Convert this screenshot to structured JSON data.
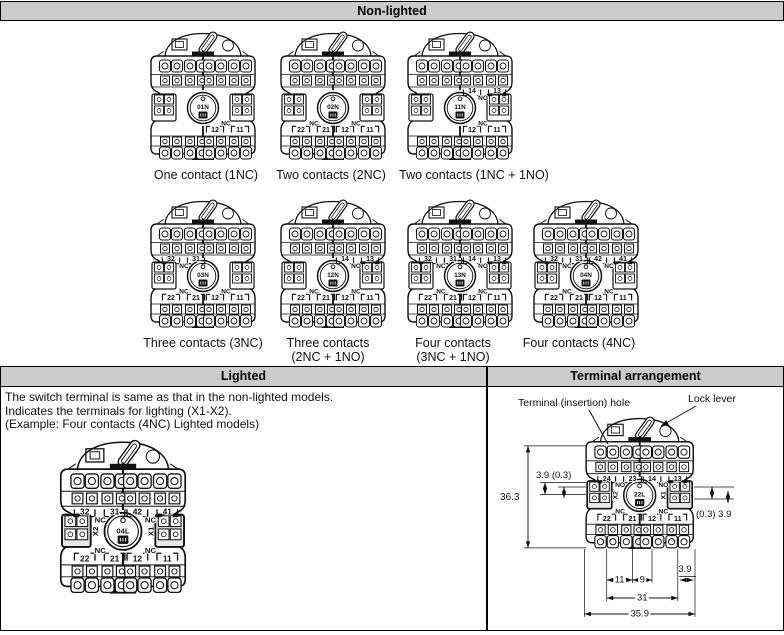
{
  "sections": {
    "non_lighted": {
      "title": "Non-lighted"
    },
    "lighted": {
      "title": "Lighted",
      "notes": [
        "The switch terminal is same as that in the non-lighted models.",
        "Indicates the terminals for lighting (X1-X2).",
        "(Example: Four contacts (4NC) Lighted models)"
      ]
    },
    "terminal_arrangement": {
      "title": "Terminal arrangement",
      "callouts": {
        "terminal_hole": "Terminal (insertion) hole",
        "lock_lever": "Lock lever"
      },
      "dimensions": {
        "left_top": "3.9 (0.3)",
        "height": "36.3",
        "right_side": "(0.3) 3.9",
        "pitch_left": "11",
        "pitch_center": "9",
        "edge_right": "3.9",
        "terminal_span": "31",
        "body_width": "35.9"
      }
    }
  },
  "switches": [
    {
      "model": "01N",
      "caption": [
        "One contact (1NC)"
      ],
      "top_numbers": [
        "",
        "",
        "",
        ""
      ],
      "top_labels": [
        "",
        ""
      ],
      "bottom_numbers": [
        "",
        "",
        "12",
        "11"
      ],
      "bottom_labels": [
        "",
        "NC"
      ],
      "side_left": "",
      "side_right": ""
    },
    {
      "model": "02N",
      "caption": [
        "Two contacts (2NC)"
      ],
      "top_numbers": [
        "",
        "",
        "",
        ""
      ],
      "top_labels": [
        "",
        ""
      ],
      "bottom_numbers": [
        "22",
        "21",
        "12",
        "11"
      ],
      "bottom_labels": [
        "NC",
        "NC"
      ],
      "side_left": "",
      "side_right": ""
    },
    {
      "model": "11N",
      "caption": [
        "Two contacts (1NC + 1NO)"
      ],
      "top_numbers": [
        "",
        "",
        "14",
        "13"
      ],
      "top_labels": [
        "",
        "NO"
      ],
      "bottom_numbers": [
        "",
        "",
        "12",
        "11"
      ],
      "bottom_labels": [
        "",
        "NC"
      ],
      "side_left": "",
      "side_right": ""
    },
    {
      "model": "03N",
      "caption": [
        "Three contacts (3NC)"
      ],
      "top_numbers": [
        "32",
        "31",
        "",
        ""
      ],
      "top_labels": [
        "NC",
        ""
      ],
      "bottom_numbers": [
        "22",
        "21",
        "12",
        "11"
      ],
      "bottom_labels": [
        "NC",
        "NC"
      ],
      "side_left": "",
      "side_right": ""
    },
    {
      "model": "12N",
      "caption": [
        "Three contacts",
        "(2NC + 1NO)"
      ],
      "top_numbers": [
        "",
        "",
        "14",
        "13"
      ],
      "top_labels": [
        "",
        "NO"
      ],
      "bottom_numbers": [
        "22",
        "21",
        "12",
        "11"
      ],
      "bottom_labels": [
        "NC",
        "NC"
      ],
      "side_left": "",
      "side_right": ""
    },
    {
      "model": "13N",
      "caption": [
        "Four contacts",
        "(3NC + 1NO)"
      ],
      "top_numbers": [
        "32",
        "31",
        "14",
        "13"
      ],
      "top_labels": [
        "NC",
        "NO"
      ],
      "bottom_numbers": [
        "22",
        "21",
        "12",
        "11"
      ],
      "bottom_labels": [
        "NC",
        "NC"
      ],
      "side_left": "",
      "side_right": ""
    },
    {
      "model": "04N",
      "caption": [
        "Four contacts (4NC)"
      ],
      "top_numbers": [
        "32",
        "31",
        "42",
        "41"
      ],
      "top_labels": [
        "NC",
        "NC"
      ],
      "bottom_numbers": [
        "22",
        "21",
        "12",
        "11"
      ],
      "bottom_labels": [
        "NC",
        "NC"
      ],
      "side_left": "",
      "side_right": ""
    },
    {
      "model": "04L",
      "caption": [],
      "top_numbers": [
        "32",
        "31",
        "42",
        "41"
      ],
      "top_labels": [
        "NC",
        "NC"
      ],
      "bottom_numbers": [
        "22",
        "21",
        "12",
        "11"
      ],
      "bottom_labels": [
        "NC",
        "NC"
      ],
      "side_left": "X2",
      "side_right": "X1"
    },
    {
      "model": "22L",
      "caption": [],
      "top_numbers": [
        "24",
        "23",
        "14",
        "13"
      ],
      "top_labels": [
        "NO",
        "NO"
      ],
      "bottom_numbers": [
        "22",
        "21",
        "12",
        "11"
      ],
      "bottom_labels": [
        "NC",
        "NC"
      ],
      "side_left": "X2",
      "side_right": "X1"
    }
  ],
  "colors": {
    "header_bg": "#cbcbcb",
    "line": "#111111",
    "bg": "#ffffff"
  }
}
